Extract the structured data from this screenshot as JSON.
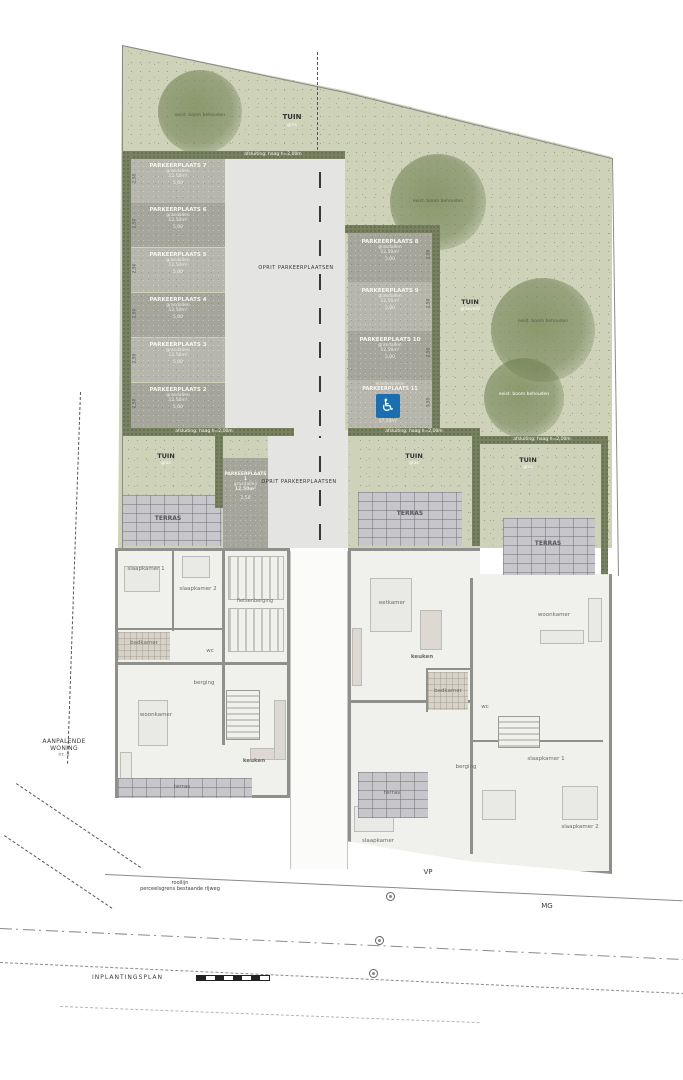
{
  "plan": {
    "title": "INPLANTINGSPLAN"
  },
  "colors": {
    "garden": "#cdd2b9",
    "hedge": "#77815f",
    "driveway": "#e4e4e2",
    "stall_light": "#b6b6ac",
    "stall_dark": "#a5a59b",
    "terras": "#c7c7cb",
    "handicap_blue": "#1a6fb0",
    "wall": "#8f8f8b",
    "room": "#f0f0ec"
  },
  "icons": {
    "wheelchair": "♿"
  },
  "garden": {
    "tuin_top": {
      "label": "TUIN",
      "sub": "gras"
    },
    "tuin_mid": {
      "label": "TUIN",
      "sub": "grasveld"
    },
    "tree_label": "exist. boom behouden",
    "hedge_top_label": "afsluiting: haag h=2,00m",
    "plots": [
      {
        "tuin": "TUIN",
        "sub": "gras",
        "terras": "TERRAS"
      },
      {
        "tuin": "TUIN",
        "sub": "gras",
        "terras": "TERRAS"
      },
      {
        "tuin": "TUIN",
        "sub": "gras",
        "terras": "TERRAS"
      }
    ]
  },
  "parking": {
    "driveway_label": "OPRIT PARKEERPLAATSEN",
    "left": [
      {
        "title": "PARKEERPLAATS 7",
        "surface": "grasdallen",
        "area": "12,50m²",
        "w": "5,00",
        "d": "2,50"
      },
      {
        "title": "PARKEERPLAATS 6",
        "surface": "grasdallen",
        "area": "12,50m²",
        "w": "5,00",
        "d": "2,50"
      },
      {
        "title": "PARKEERPLAATS 5",
        "surface": "grasdallen",
        "area": "12,50m²",
        "w": "5,00",
        "d": "2,50"
      },
      {
        "title": "PARKEERPLAATS 4",
        "surface": "grasdallen",
        "area": "12,50m²",
        "w": "5,00",
        "d": "2,50"
      },
      {
        "title": "PARKEERPLAATS 3",
        "surface": "grasdallen",
        "area": "12,50m²",
        "w": "5,00",
        "d": "2,50"
      },
      {
        "title": "PARKEERPLAATS 2",
        "surface": "grasdallen",
        "area": "12,50m²",
        "w": "5,00",
        "d": "2,50"
      }
    ],
    "right": [
      {
        "title": "PARKEERPLAATS 8",
        "surface": "grasdallen",
        "area": "12,50m²",
        "w": "5,00",
        "d": "2,50"
      },
      {
        "title": "PARKEERPLAATS 9",
        "surface": "grasdallen",
        "area": "12,50m²",
        "w": "5,00",
        "d": "2,50"
      },
      {
        "title": "PARKEERPLAATS 10",
        "surface": "grasdallen",
        "area": "12,50m²",
        "w": "5,00",
        "d": "2,50"
      }
    ],
    "handicap": {
      "pre": "mindervaliden",
      "title": "PARKEERPLAATS 11",
      "area": "17,50m²",
      "d": "3,50"
    },
    "first": {
      "title": "PARKEERPLAATS 1",
      "surface": "grasdallen",
      "area": "12,50m²",
      "d": "2,50"
    }
  },
  "rooms": {
    "left": {
      "slk1": "slaapkamer 1",
      "slk2": "slaapkamer 2",
      "badk": "badkamer",
      "fiets": "fietsenberging",
      "wc": "wc",
      "woon": "woonkamer",
      "berg": "berging",
      "keuk": "keuken",
      "terras": "terras"
    },
    "right": {
      "eet": "eetkamer",
      "keuk": "keuken",
      "woon": "woonkamer",
      "badk": "badkamer",
      "wc": "wc",
      "slk1": "slaapkamer 1",
      "berg": "berging",
      "slk2": "slaapkamer 2",
      "slk3": "slaapkamer",
      "terras": "terras"
    }
  },
  "annotations": {
    "vp": "VP",
    "mg": "MG",
    "note1": "rooilijn",
    "note2": "perceelsgrens bestaande rijweg",
    "adjacent1": "AANPALENDE",
    "adjacent2": "WONING",
    "adjacent3": "nr. 8"
  }
}
